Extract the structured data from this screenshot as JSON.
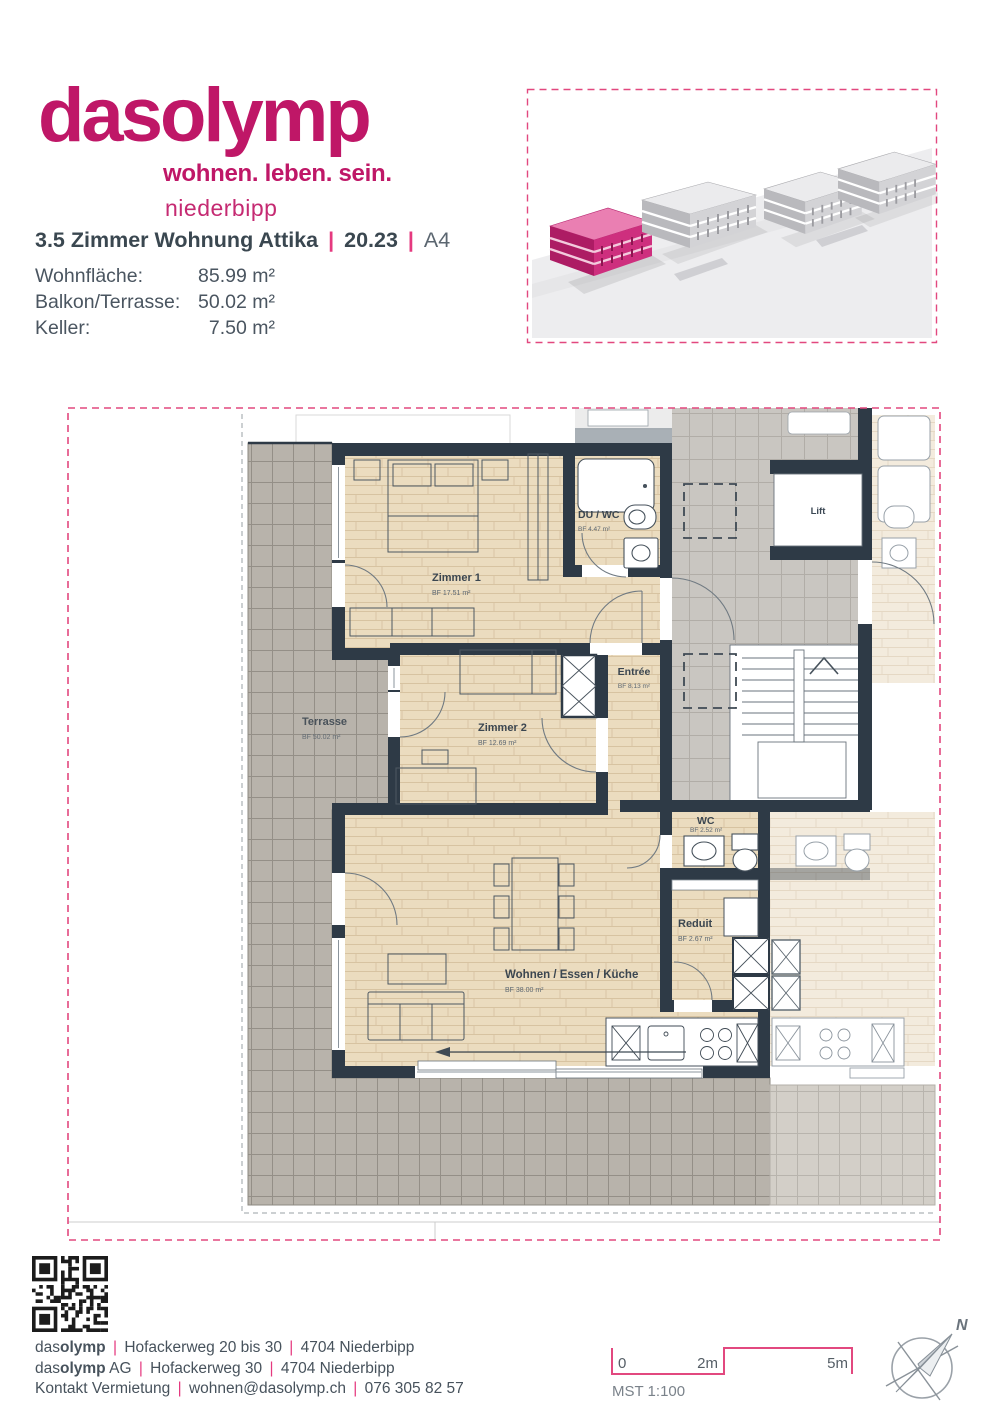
{
  "brand": {
    "name_regular": "das",
    "name_bold": "olymp",
    "tagline": "wohnen. leben. sein.",
    "city": "niederbipp",
    "color": "#bf1767"
  },
  "listing": {
    "title": "3.5 Zimmer Wohnung Attika",
    "sep": "|",
    "unit": "20.23",
    "plan_code": "A4",
    "areas": [
      {
        "label": "Wohnfläche:",
        "value": "85.99 m²"
      },
      {
        "label": "Balkon/Terrasse:",
        "value": "50.02 m²"
      },
      {
        "label": "Keller:",
        "value": "7.50 m²"
      }
    ]
  },
  "floorplan": {
    "rooms": {
      "zimmer1": {
        "name": "Zimmer 1",
        "bf": "BF 17.51 m²"
      },
      "duwc": {
        "name": "DU / WC",
        "bf": "BF 4.47 m²"
      },
      "entree": {
        "name": "Entrée",
        "bf": "BF 8.13 m²"
      },
      "zimmer2": {
        "name": "Zimmer 2",
        "bf": "BF 12.69 m²"
      },
      "terrasse": {
        "name": "Terrasse",
        "bf": "BF 50.02 m²"
      },
      "wc": {
        "name": "WC",
        "bf": "BF 2.52 m²"
      },
      "reduit": {
        "name": "Reduit",
        "bf": "BF 2.67 m²"
      },
      "wohnen": {
        "name": "Wohnen / Essen / Küche",
        "bf": "BF 38.00 m²"
      },
      "lift": {
        "name": "Lift"
      }
    },
    "colors": {
      "wall": "#2e3a46",
      "floor": "#ebdcbf",
      "terrace": "#b8b3ab",
      "border": "#e2487f"
    }
  },
  "siteplan": {
    "highlight_color": "#ce2f7e"
  },
  "scale": {
    "zero": "0",
    "two": "2m",
    "five": "5m",
    "label": "MST 1:100"
  },
  "compass": {
    "north": "N"
  },
  "footer": {
    "sep": "|",
    "line1": {
      "brand_a": "das",
      "brand_b": "olymp",
      "street": "Hofackerweg 20 bis 30",
      "city": "4704 Niederbipp"
    },
    "line2": {
      "brand_a": "das",
      "brand_b": "olymp",
      "suffix": "AG",
      "street": "Hofackerweg 30",
      "city": "4704 Niederbipp"
    },
    "line3": {
      "contact": "Kontakt Vermietung",
      "email": "wohnen@dasolymp.ch",
      "phone": "076 305 82 57"
    }
  }
}
